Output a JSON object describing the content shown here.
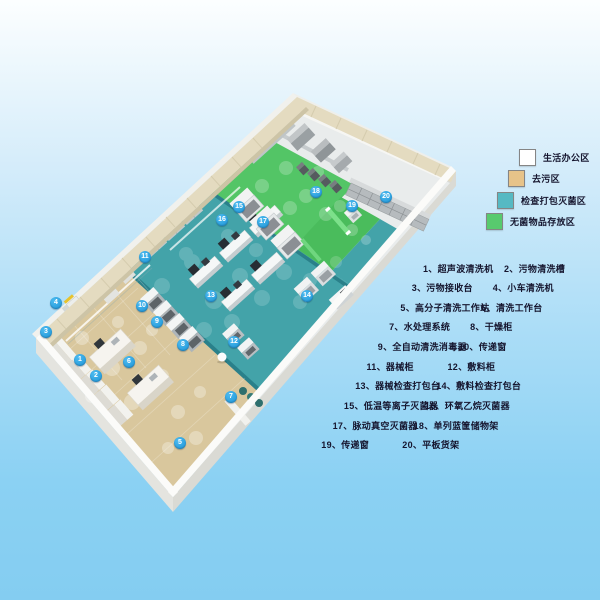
{
  "legend": {
    "items": [
      {
        "label": "生活办公区",
        "color": "#ffffff"
      },
      {
        "label": "去污区",
        "color": "#e7c389"
      },
      {
        "label": "检查打包灭菌区",
        "color": "#56b9c3"
      },
      {
        "label": "无菌物品存放区",
        "color": "#58ca6e"
      }
    ]
  },
  "equipment_list": {
    "rows": [
      {
        "left": "1、超声波清洗机",
        "right": "2、污物清洗槽"
      },
      {
        "left": "3、污物接收台",
        "right": "4、小车清洗机"
      },
      {
        "left": "5、高分子清洗工作站",
        "right": "6、清洗工作台"
      },
      {
        "left": "7、水处理系统",
        "right": "8、干燥柜"
      },
      {
        "left": "9、全自动清洗消毒器",
        "right": "10、传递窗"
      },
      {
        "left": "11、器械柜",
        "right": "12、敷料柜"
      },
      {
        "left": "13、器械检查打包台",
        "right": "14、敷料检查打包台"
      },
      {
        "left": "15、低温等离子灭菌器",
        "right": "16、环氧乙烷灭菌器"
      },
      {
        "left": "17、脉动真空灭菌器",
        "right": "18、单列蓝筐储物架"
      },
      {
        "left": "19、传递窗",
        "right": "20、平板货架"
      }
    ]
  },
  "markers": [
    {
      "n": "1",
      "x": 80,
      "y": 360
    },
    {
      "n": "2",
      "x": 96,
      "y": 376
    },
    {
      "n": "3",
      "x": 46,
      "y": 332
    },
    {
      "n": "4",
      "x": 56,
      "y": 303
    },
    {
      "n": "5",
      "x": 180,
      "y": 443
    },
    {
      "n": "6",
      "x": 129,
      "y": 362
    },
    {
      "n": "7",
      "x": 231,
      "y": 397
    },
    {
      "n": "8",
      "x": 183,
      "y": 345
    },
    {
      "n": "9",
      "x": 157,
      "y": 322
    },
    {
      "n": "10",
      "x": 142,
      "y": 306
    },
    {
      "n": "11",
      "x": 145,
      "y": 257
    },
    {
      "n": "12",
      "x": 234,
      "y": 342
    },
    {
      "n": "13",
      "x": 211,
      "y": 296
    },
    {
      "n": "14",
      "x": 307,
      "y": 296
    },
    {
      "n": "15",
      "x": 239,
      "y": 207
    },
    {
      "n": "16",
      "x": 222,
      "y": 220
    },
    {
      "n": "17",
      "x": 263,
      "y": 222
    },
    {
      "n": "18",
      "x": 316,
      "y": 192
    },
    {
      "n": "19",
      "x": 352,
      "y": 206
    },
    {
      "n": "20",
      "x": 386,
      "y": 197
    }
  ],
  "colors": {
    "text": "#15152e",
    "marker_blue": "#2ba6e4",
    "zone_decontamination": "#d9c79d",
    "zone_inspection": "#43a3a9",
    "zone_sterile": "#53c566",
    "zone_sterile_ext": "#4abc5c",
    "zone_far_white": "#e9ecec",
    "wall_beige": "#e4dbc0",
    "slab_white": "#f6f6f3"
  }
}
